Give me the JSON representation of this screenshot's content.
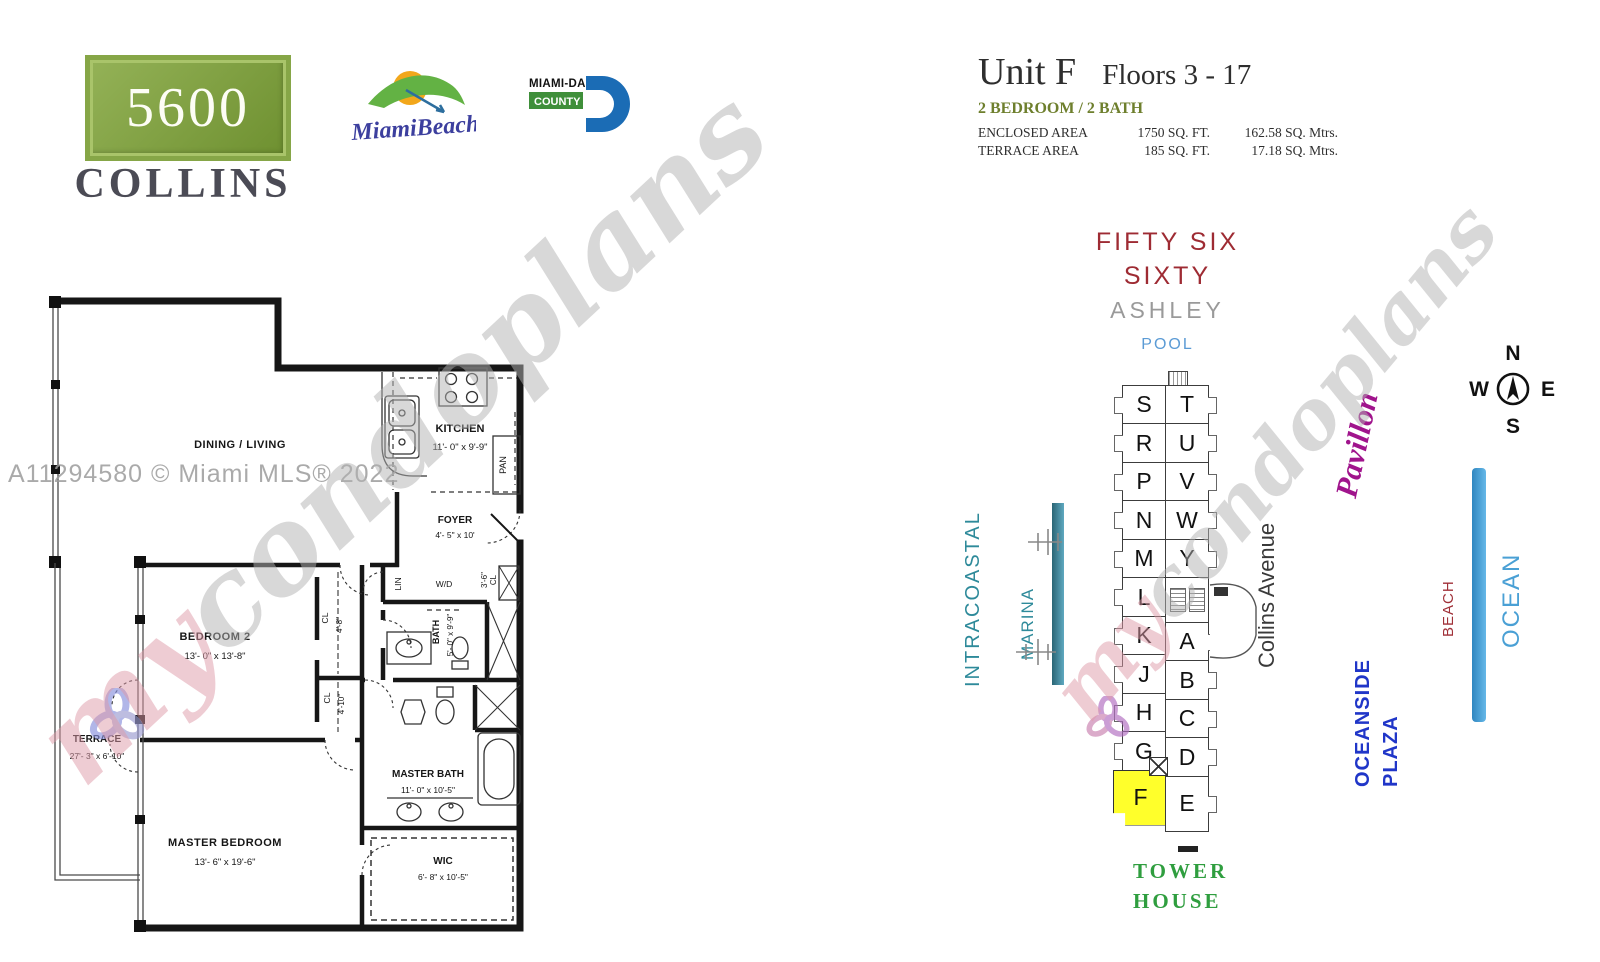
{
  "header": {
    "building_number": "5600",
    "building_name": "COLLINS",
    "miami_beach_logo_text": "MiamiBeach",
    "miami_dade_logo": {
      "line1": "MIAMI-DADE",
      "line2": "COUNTY"
    }
  },
  "unit_info": {
    "title": "Unit F",
    "floors": "Floors 3 - 17",
    "configuration": "2 BEDROOM / 2 BATH",
    "areas": [
      {
        "label": "ENCLOSED AREA",
        "sqft": "1750 SQ. FT.",
        "metric": "162.58 SQ. Mtrs."
      },
      {
        "label": "TERRACE AREA",
        "sqft": "185 SQ. FT.",
        "metric": "17.18 SQ. Mtrs."
      }
    ]
  },
  "floor_plan": {
    "rooms": {
      "dining_living": {
        "name": "DINING / LIVING"
      },
      "kitchen": {
        "name": "KITCHEN",
        "dims": "11'- 0\" x 9'-9\""
      },
      "foyer": {
        "name": "FOYER",
        "dims": "4'- 5\" x 10'"
      },
      "bedroom2": {
        "name": "BEDROOM 2",
        "dims": "13'- 0\" x 13'-8\""
      },
      "bath": {
        "name": "BATH",
        "dims": "5'- 0\" x 9'-9\""
      },
      "master_bath": {
        "name": "MASTER BATH",
        "dims": "11'- 0\" x 10'-5\""
      },
      "wic": {
        "name": "WIC",
        "dims": "6'- 8\" x 10'-5\""
      },
      "master_bedroom": {
        "name": "MASTER BEDROOM",
        "dims": "13'- 6\" x 19'-6\""
      },
      "terrace": {
        "name": "TERRACE",
        "dims": "27'- 3\" x 6'-10\""
      },
      "pan": "PAN",
      "lin": "LIN",
      "wd": "W/D",
      "cl_a": {
        "name": "CL",
        "dims": "4'-8\""
      },
      "cl_b": {
        "name": "CL",
        "dims": "4'-10\""
      },
      "cl_c": {
        "name": "CL",
        "dims": "3'-6\""
      }
    }
  },
  "site_map": {
    "north_labels": {
      "line1": "FIFTY SIX",
      "line2": "SIXTY",
      "neighbor": "ASHLEY",
      "pool": "POOL"
    },
    "tower_units_west": [
      "S",
      "R",
      "P",
      "N",
      "M",
      "L",
      "K",
      "J",
      "H",
      "G"
    ],
    "highlighted_unit": "F",
    "tower_units_east_upper": [
      "T",
      "U",
      "V",
      "W",
      "Y"
    ],
    "tower_units_east_lower": [
      "A",
      "B",
      "C",
      "D",
      "E"
    ],
    "street": "Collins Avenue",
    "pavillon": "Pavillon",
    "intracoastal": "INTRACOASTAL",
    "marina": "MARINA",
    "beach": "BEACH",
    "ocean": "OCEAN",
    "oceanside_line1": "OCEANSIDE",
    "oceanside_line2": "PLAZA",
    "tower_house_line1": "TOWER",
    "tower_house_line2": "HOUSE",
    "compass": {
      "n": "N",
      "e": "E",
      "s": "S",
      "w": "W"
    }
  },
  "watermark": {
    "my": "my",
    "rest": "condoplans",
    "mls": "A11294580 © Miami MLS® 2022"
  },
  "colors": {
    "badge_green": "#7d9c3c",
    "config_olive": "#6e7f2d",
    "fifty_six_red": "#9e2b33",
    "pool_blue": "#5b9bd5",
    "intracoastal_teal": "#2e8a9a",
    "beach_red": "#a03038",
    "ocean_blue": "#4aa0d5",
    "oceanside_blue": "#2036c8",
    "tower_house_green": "#2f9e3f",
    "pavillon_magenta": "#a0148c",
    "highlight_yellow": "#ffff2b"
  }
}
